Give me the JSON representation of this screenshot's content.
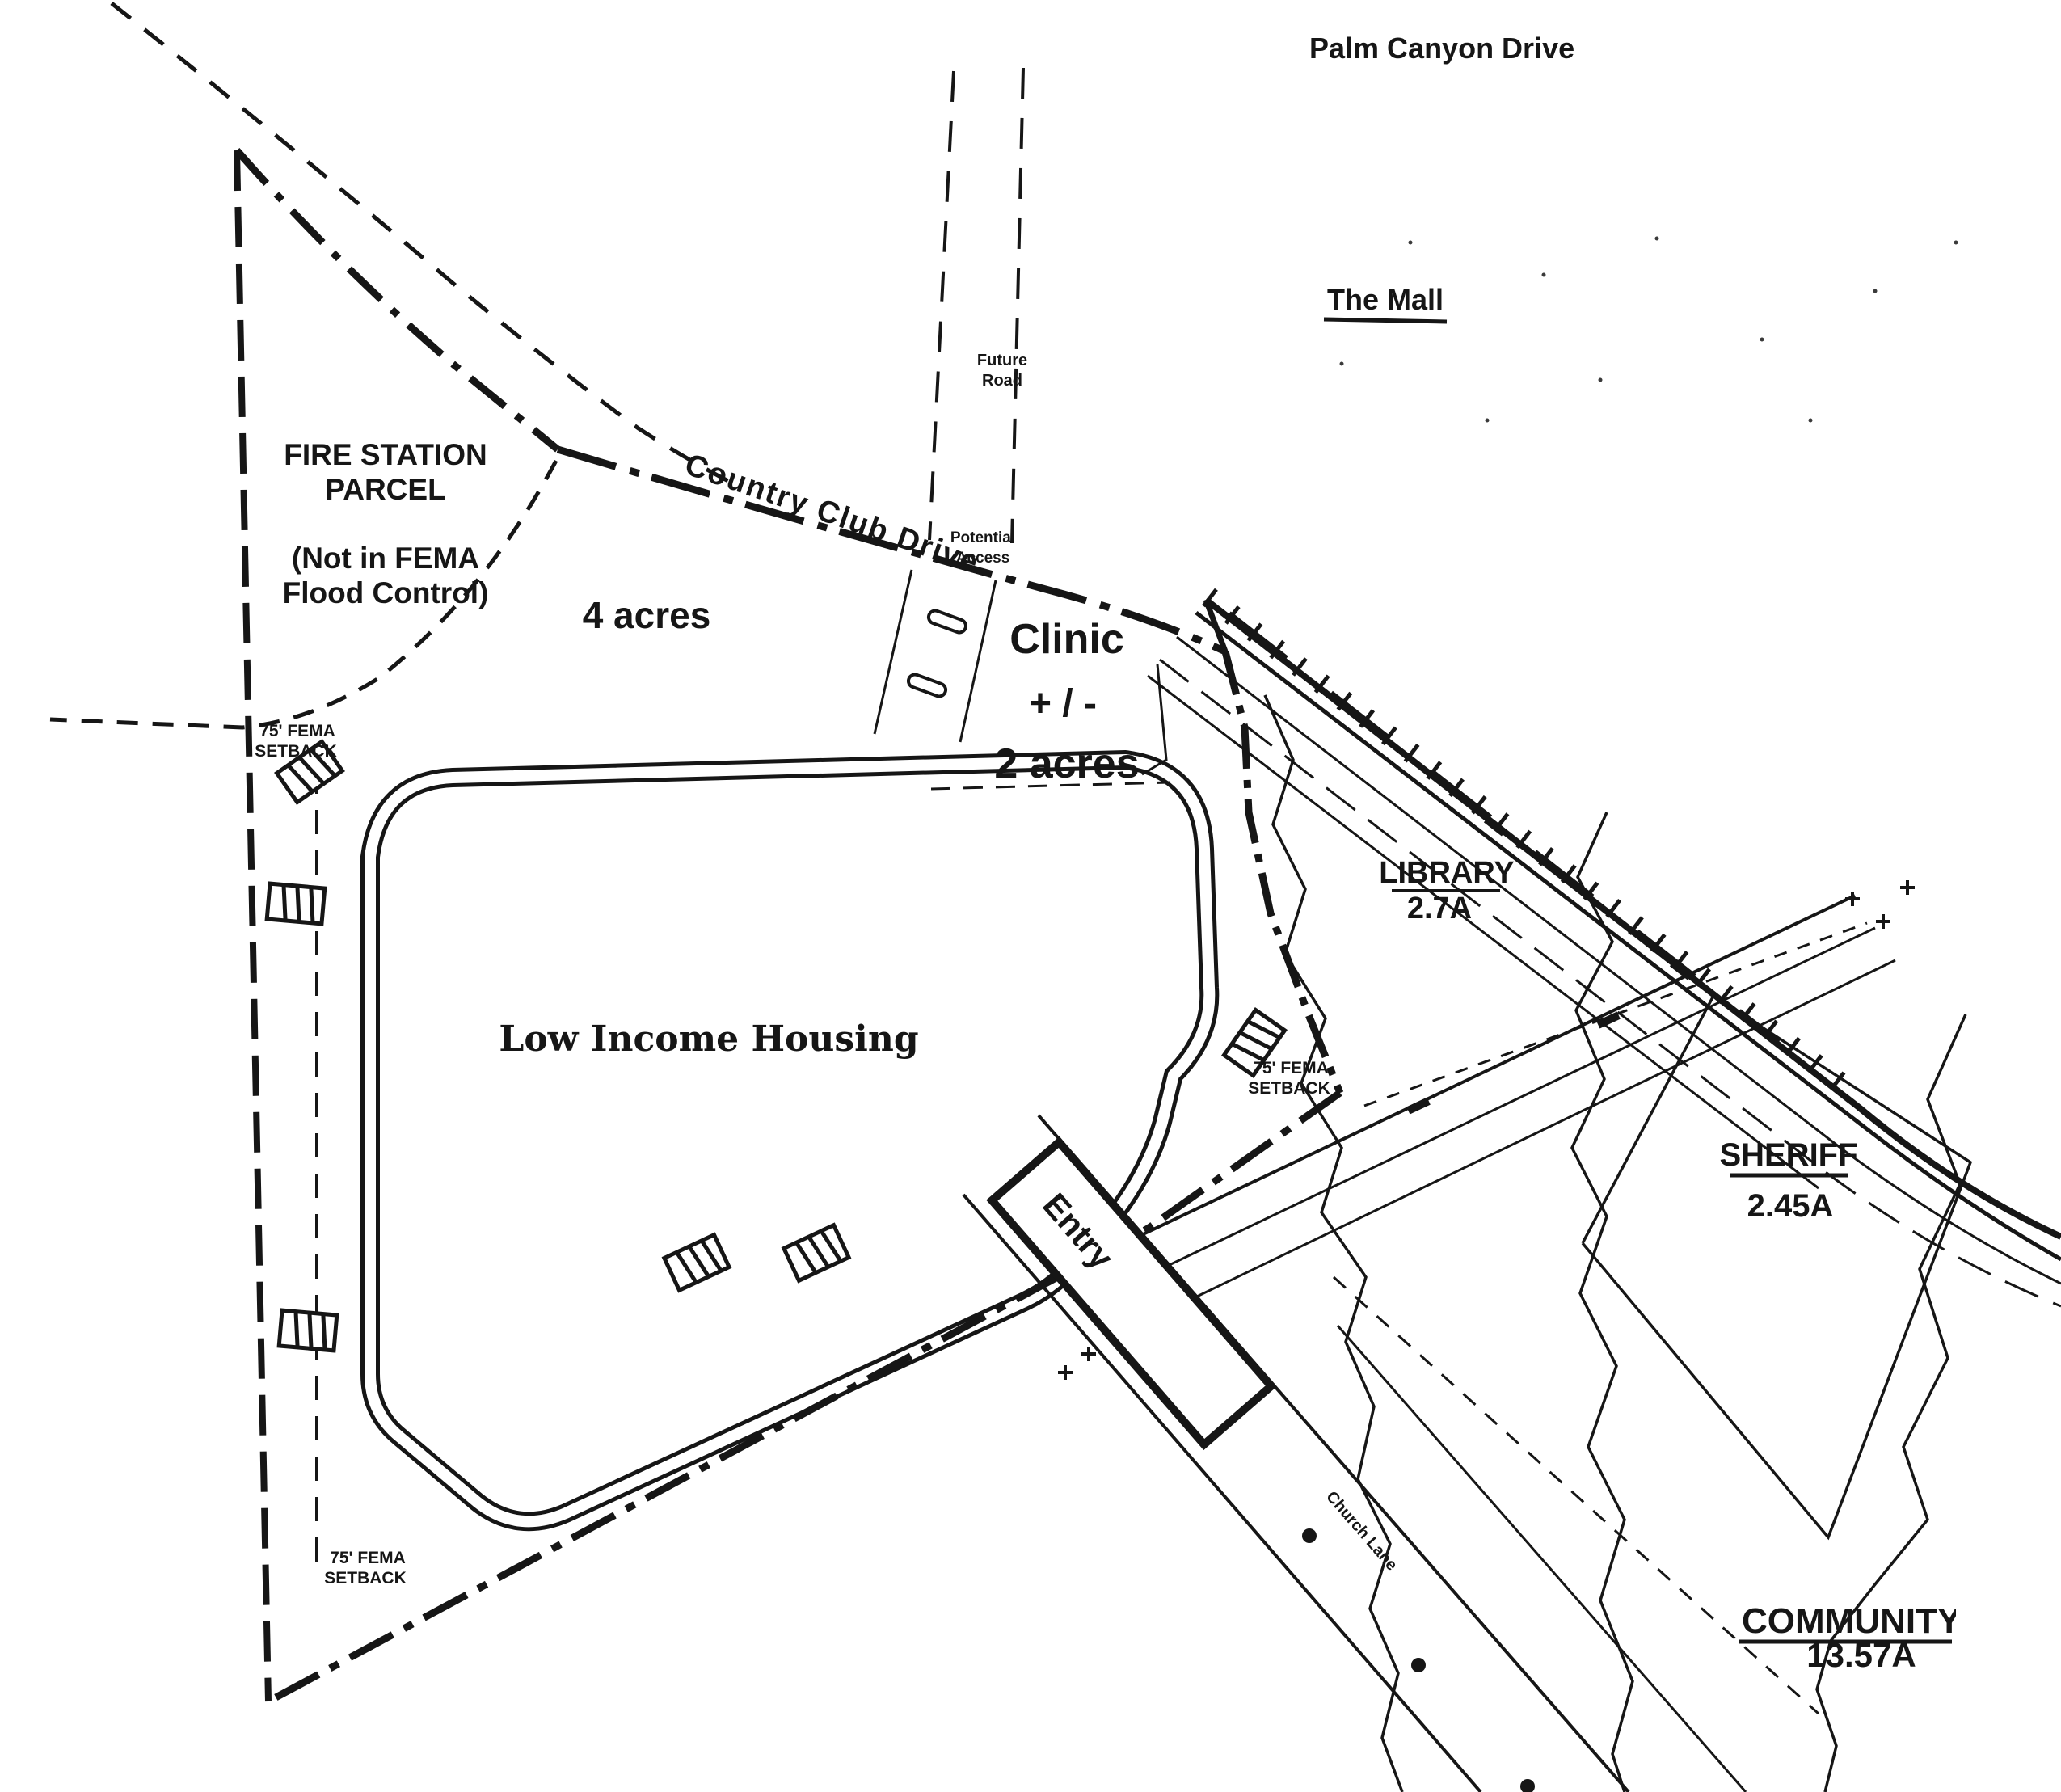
{
  "map": {
    "paper_color": "#ffffff",
    "ink_color": "#161616",
    "roads": {
      "palm_canyon_drive": "Palm Canyon Drive",
      "country_club_drive": "Country Club Drive",
      "future_road": [
        "Future",
        "Road"
      ],
      "potential_access": [
        "Potential",
        "Access"
      ],
      "entry": "Entry",
      "church_lane": "Church Lane"
    },
    "landmarks": {
      "the_mall": "The Mall"
    },
    "parcels": {
      "fire_station": {
        "title": [
          "FIRE STATION",
          "PARCEL"
        ],
        "note": [
          "(Not in FEMA",
          "Flood Control)"
        ],
        "area": "4 acres"
      },
      "clinic": {
        "title": "Clinic",
        "tolerance": "+ / -",
        "area": "2 acres"
      },
      "low_income_housing": {
        "title": "Low Income Housing"
      },
      "library": {
        "title": "LIBRARY",
        "area": "2.7A"
      },
      "sheriff": {
        "title": "SHERIFF",
        "area": "2.45A"
      },
      "community_park": {
        "title": "COMMUNITY PARK",
        "area": "13.57A"
      }
    },
    "annotations": {
      "fema_setback": [
        "75' FEMA",
        "SETBACK"
      ]
    }
  }
}
